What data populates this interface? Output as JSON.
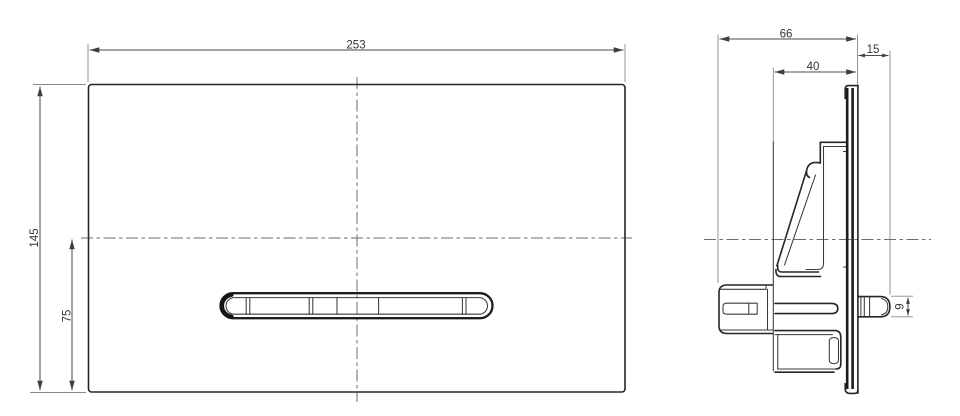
{
  "drawing": {
    "type": "technical-drawing-flush-plate",
    "views": {
      "front": {
        "dimensions": {
          "overall_width": "253",
          "overall_height": "145",
          "button_axis_from_bottom": "75"
        }
      },
      "side": {
        "dimensions": {
          "overall_depth": "66",
          "panel_offset": "15",
          "frame_depth": "40",
          "button_protrusion": "9"
        }
      }
    },
    "colors": {
      "background": "#ffffff",
      "object_line": "#262626",
      "dimension_line": "#4a4a4a",
      "extension_line": "#8a8a8a",
      "centerline": "#6b6b6b",
      "text": "#333333"
    }
  }
}
